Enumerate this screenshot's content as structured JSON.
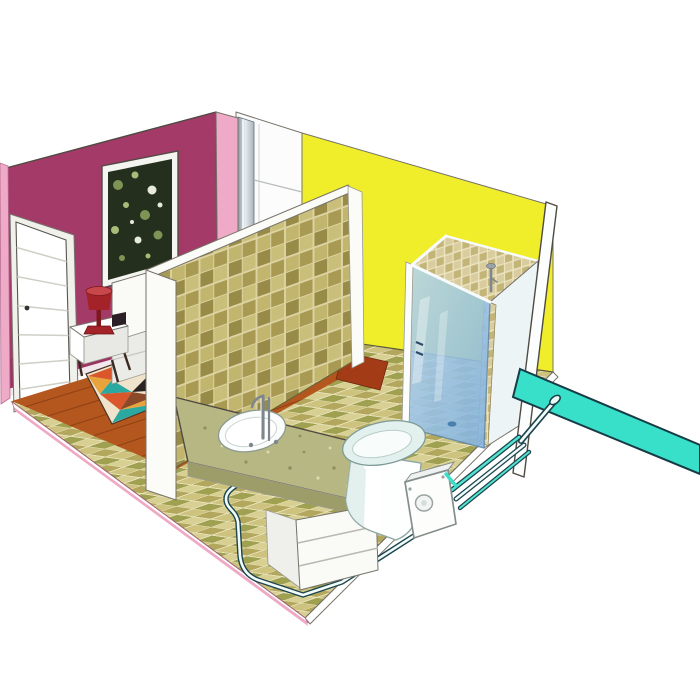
{
  "meta": {
    "type": "illustration",
    "subject": "cutaway-3d-view-bedroom-and-ensuite-bathroom-with-macerator-pump-plumbing"
  },
  "scene": {
    "objects": [
      "maroon-bedroom-wall",
      "pink-wall-cut-edge",
      "corner-pipe-duct",
      "yellow-bathroom-wall",
      "right-wall-edge",
      "tiled-partition-wall",
      "bedroom-door",
      "framed-picture",
      "bed",
      "nightstand",
      "table-lamp",
      "area-rug",
      "wood-floor",
      "tiled-floor",
      "doorway-threshold",
      "vanity-counter",
      "sink-basin",
      "faucet",
      "p-trap-drain-pipe",
      "vanity-cabinet",
      "toilet",
      "macerator-pump",
      "pump-discharge-pipes",
      "riser-pipe",
      "pipe-junction-elbow",
      "main-discharge-pipe",
      "shower-stall",
      "shower-glass-panel",
      "shower-fixture"
    ]
  },
  "colors": {
    "bg": "#ffffff",
    "wall_maroon": "#a43a68",
    "wall_maroon_dark": "#8e2f58",
    "pink_edge": "#efaac7",
    "wall_white": "#fbfcfb",
    "silver_a": "#aab4bc",
    "silver_b": "#e7ecef",
    "silver_c": "#8b97a0",
    "wall_yellow": "#f0ee2a",
    "door_frame": "#f1f1ec",
    "door_white": "#ffffff",
    "picture_frame": "#f4f4f0",
    "art_bg": "#24301d",
    "art_speck_a": "#7e9455",
    "art_speck_b": "#aabb79",
    "art_speck_c": "#e7e9da",
    "bed_white": "#fafaf7",
    "bed_shade": "#ebebe7",
    "nightstand_white": "#ffffff",
    "nightstand_side": "#e8e8e4",
    "lamp_red": "#a42328",
    "lamp_red_light": "#c8474b",
    "lamp_red_dark": "#7e181d",
    "wood": "#b4571f",
    "wood_line": "#8a3c10",
    "rug_cream": "#efe3cc",
    "rug_red": "#d9572b",
    "rug_orange": "#e8a33c",
    "rug_teal": "#2ba8a0",
    "rug_black": "#2a2420",
    "rug_brown": "#8a4a2a",
    "threshold_red": "#a33b17",
    "grout_wall": "#ddd3a2",
    "tile_wall_a": "#c2b56e",
    "tile_wall_b": "#a89a52",
    "tile_wall_c": "#cabf7a",
    "tile_wall_d": "#988b47",
    "grout_floor": "#e8e2ba",
    "tile_floor_a": "#cdc37f",
    "tile_floor_b": "#b2a75c",
    "tile_floor_c": "#d8cf92",
    "tile_floor_d": "#a0a051",
    "grout_shower": "#ece4c0",
    "tile_shower_a": "#d9cd9f",
    "tile_shower_b": "#c3b478",
    "partition_white": "#fbfbf8",
    "counter_top": "#b6b782",
    "counter_edge": "#9c9d68",
    "counter_speck_dark": "#8f9060",
    "counter_speck_light": "#dadbb0",
    "cabinet_white": "#fafaf7",
    "cabinet_side": "#efefeb",
    "sink_white": "#fbfdfd",
    "toilet_white": "#fdfefe",
    "toilet_seat": "#e2f1ee",
    "toilet_shade": "#d9ebe8",
    "pump_white": "#fdfdfc",
    "pump_top": "#eef1f0",
    "pump_cap": "#f2f5f4",
    "glass_light": "#b7d6f0",
    "glass_dark": "#7fb2e2",
    "glass_streak": "#ffffff",
    "panel_pale": "#ecf4f6",
    "strip_white": "#fcfdfd",
    "pipe_teal": "#38e0ca",
    "pipe_dark": "#1d454e",
    "pipe_core_teal": "#52e4d0",
    "pipe_core_white": "#f2fdfb",
    "elbow_white": "#e8fbf7",
    "drain_dot": "#4a7fae",
    "floor_edge_white": "#ffffff",
    "floor_edge_pink": "#efa9c5"
  }
}
